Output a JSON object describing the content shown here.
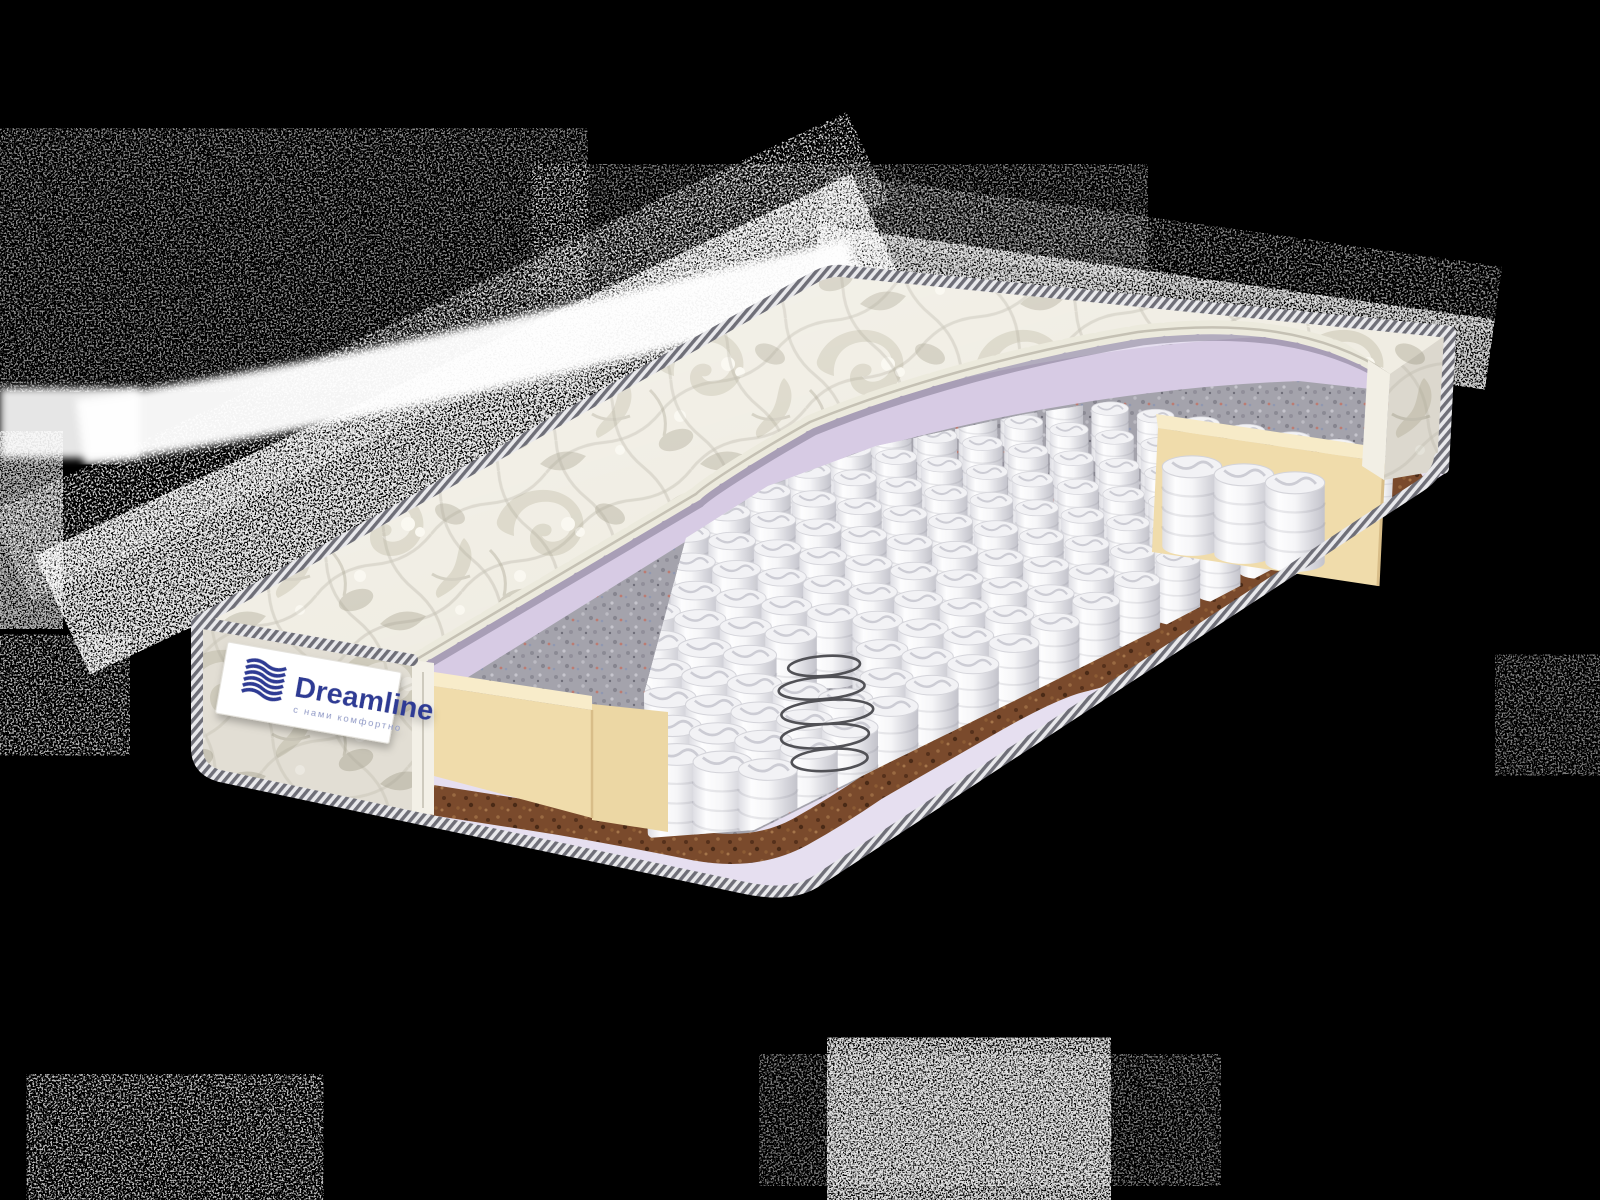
{
  "label": {
    "brand": "Dreamline",
    "tagline": "с нами комфортно"
  },
  "colors": {
    "background": "#000000",
    "brand_navy": "#2e3a94",
    "tagline_blue": "#8d97c6",
    "quilt_fabric": "#f0ede3",
    "foam_lavender": "#d7cbe4",
    "base_foam_lavender": "#e6dff0",
    "felt_grey": "#a4a3ac",
    "coir_brown": "#7a4a2c",
    "foam_cream": "#f0dcab",
    "spring_white": "#f7f7f9",
    "piping_grey": "#6f6f78",
    "noise_white": "#ffffff"
  }
}
